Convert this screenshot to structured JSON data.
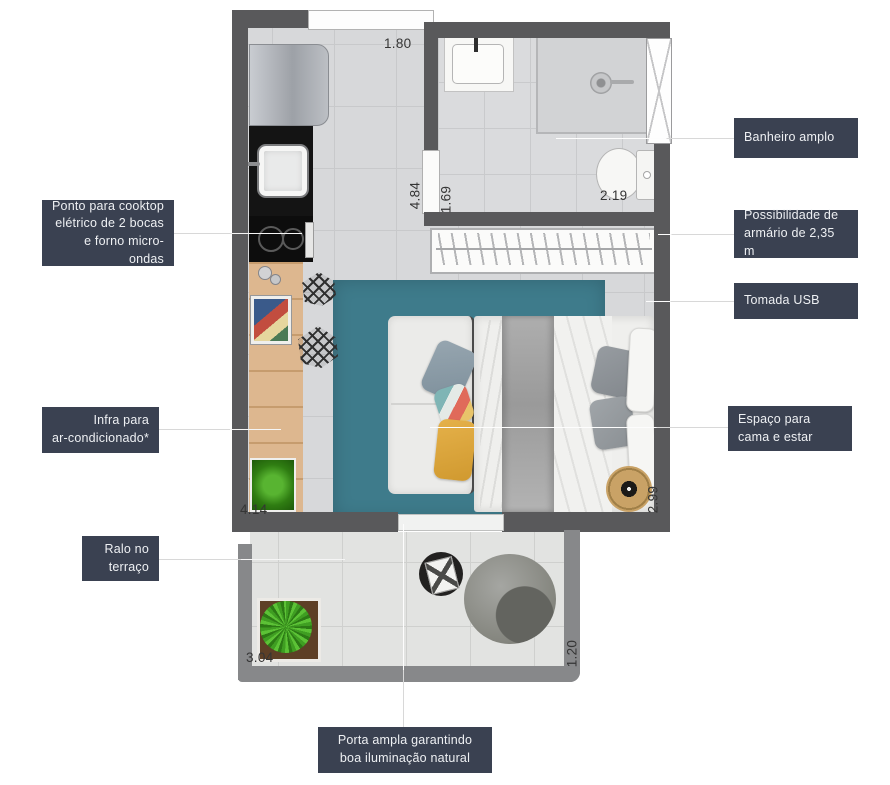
{
  "callouts": {
    "cooktop": {
      "text": "Ponto para cooktop\nelétrico de 2 bocas\ne forno micro-ondas"
    },
    "banheiro": {
      "text": "Banheiro amplo"
    },
    "armario": {
      "text": "Possibilidade de\narmário de 2,35 m"
    },
    "tomada": {
      "text": "Tomada USB"
    },
    "infra": {
      "text": "Infra para\nar-condicionado*"
    },
    "espaco": {
      "text": "Espaço para\ncama e estar"
    },
    "ralo": {
      "text": "Ralo no\nterraço"
    },
    "porta": {
      "text": "Porta ampla garantindo\nboa iluminação natural"
    }
  },
  "dimensions": {
    "entry_width": "1.80",
    "living_depth": "4.84",
    "bath_door": "1.69",
    "bath_width": "2.19",
    "kitchen_run": "4.14",
    "bed_wall": "2.99",
    "terrace_width": "3.04",
    "terrace_depth": "1.20"
  },
  "colors": {
    "callout_bg": "#3a4151",
    "callout_text": "#eef0f3",
    "wall_dark": "#59595b",
    "wall_terrace": "#87888a",
    "floor": "#d7d8da",
    "terrace_floor": "#e2e3e1",
    "rug_teal": "#3e7b8b",
    "wood": "#ddb78f",
    "pillow_yellow": "#e5b14a",
    "plant_green": "#3f9e22",
    "pouf_gold": "#c9a266"
  }
}
